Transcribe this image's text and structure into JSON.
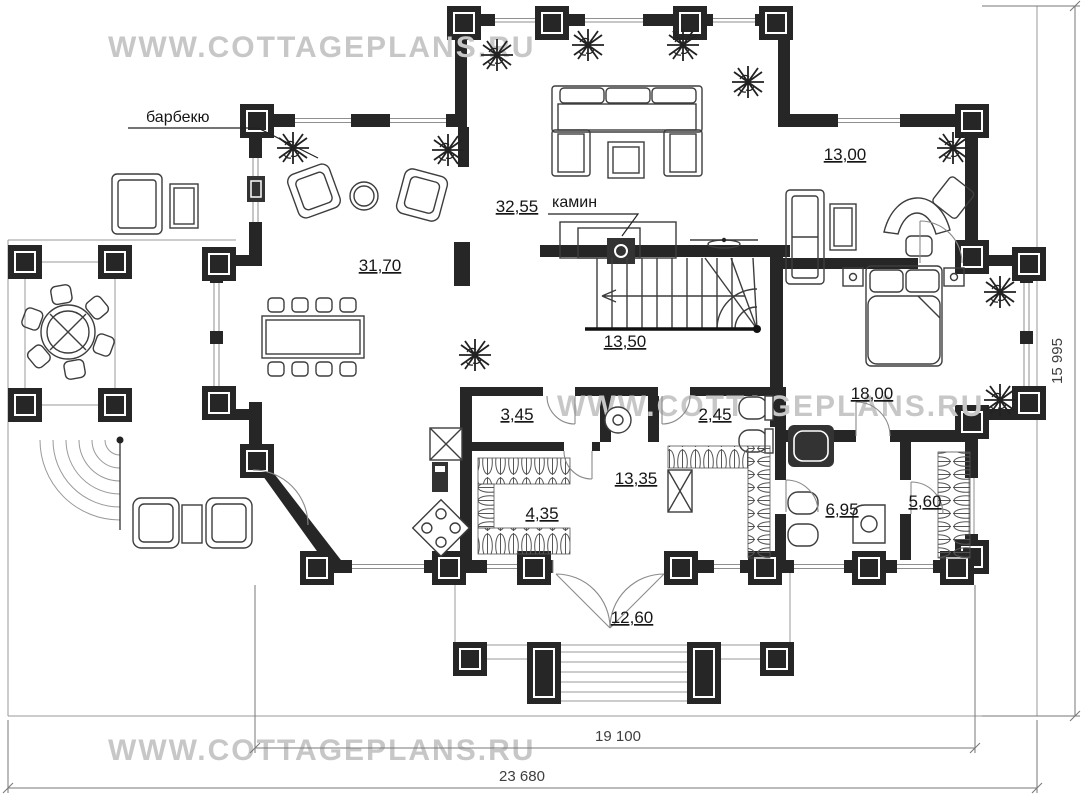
{
  "watermark": {
    "text": "WWW.COTTAGEPLANS.RU"
  },
  "annotations": {
    "barbecue": "барбекю",
    "fireplace": "камин"
  },
  "rooms": {
    "study": "13,00",
    "living": "32,55",
    "lounge": "31,70",
    "stair_hall": "13,50",
    "bedroom": "18,00",
    "utility": "3,45",
    "wc": "2,45",
    "corridor": "13,35",
    "closet": "4,35",
    "bathroom": "6,95",
    "wardrobe": "5,60",
    "porch": "12,60"
  },
  "dimensions": {
    "inner_width": "19 100",
    "total_width": "23 680",
    "total_height": "15 995"
  },
  "colors": {
    "wall": "#262626",
    "furniture_line": "#3d3d3d",
    "watermark": "#c7c7c7",
    "dim_text": "#3f3f3f"
  }
}
